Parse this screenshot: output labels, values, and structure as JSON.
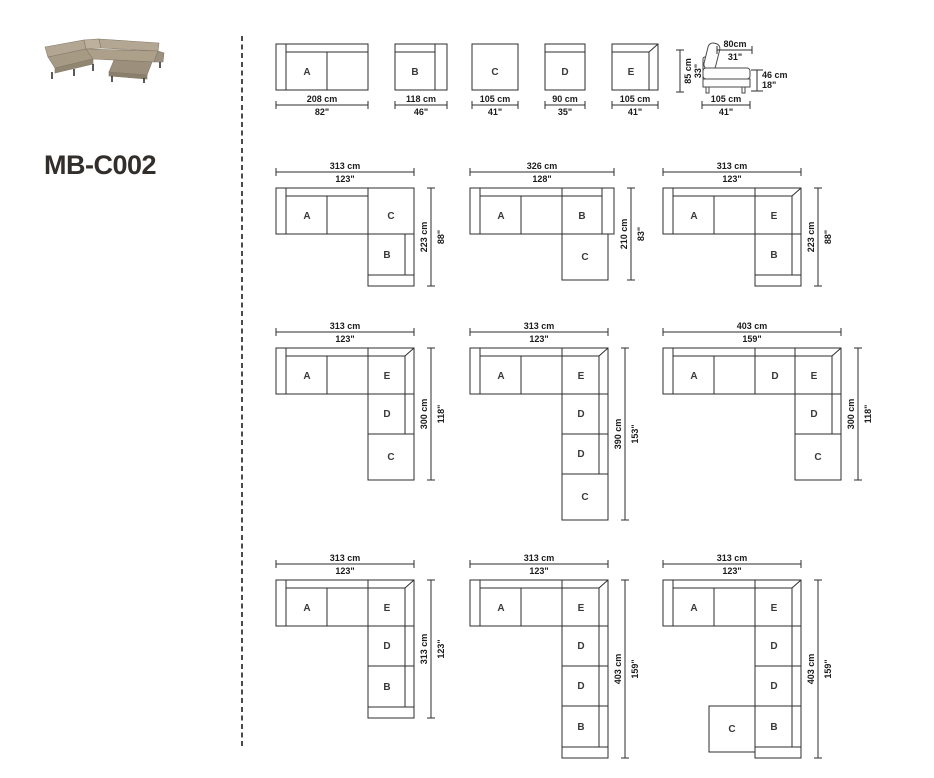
{
  "title": "MB-C002",
  "module_depth_cm": 105,
  "modules": [
    {
      "id": "A",
      "label": "A",
      "width_cm": 208,
      "dim_cm": "208 cm",
      "dim_in": "82\""
    },
    {
      "id": "B",
      "label": "B",
      "width_cm": 118,
      "dim_cm": "118 cm",
      "dim_in": "46\""
    },
    {
      "id": "C",
      "label": "C",
      "width_cm": 105,
      "dim_cm": "105 cm",
      "dim_in": "41\""
    },
    {
      "id": "D",
      "label": "D",
      "width_cm": 90,
      "dim_cm": "90 cm",
      "dim_in": "35\""
    },
    {
      "id": "E",
      "label": "E",
      "width_cm": 105,
      "dim_cm": "105 cm",
      "dim_in": "41\""
    }
  ],
  "side_view": {
    "width_top_cm": "80cm",
    "width_top_in": "31\"",
    "height_cm": "85 cm",
    "height_in": "33\"",
    "seat_height_cm": "46 cm",
    "seat_height_in": "18\"",
    "depth_cm": "105 cm",
    "depth_in": "41\""
  },
  "configurations": [
    {
      "name": "config-1",
      "width_cm": "313 cm",
      "width_in": "123\"",
      "height_cm": "223 cm",
      "height_in": "88\"",
      "top_row": [
        "A",
        "C"
      ],
      "right_column": [
        "B"
      ]
    },
    {
      "name": "config-2",
      "width_cm": "326 cm",
      "width_in": "128\"",
      "height_cm": "210 cm",
      "height_in": "83\"",
      "top_row": [
        "A",
        "B"
      ],
      "right_column": [
        "C"
      ]
    },
    {
      "name": "config-3",
      "width_cm": "313 cm",
      "width_in": "123\"",
      "height_cm": "223 cm",
      "height_in": "88\"",
      "top_row": [
        "A",
        "E"
      ],
      "right_column": [
        "B"
      ]
    },
    {
      "name": "config-4",
      "width_cm": "313 cm",
      "width_in": "123\"",
      "height_cm": "300 cm",
      "height_in": "118\"",
      "top_row": [
        "A",
        "E"
      ],
      "right_column": [
        "D",
        "C"
      ]
    },
    {
      "name": "config-5",
      "width_cm": "313 cm",
      "width_in": "123\"",
      "height_cm": "390 cm",
      "height_in": "153\"",
      "top_row": [
        "A",
        "E"
      ],
      "right_column": [
        "D",
        "D",
        "C"
      ]
    },
    {
      "name": "config-6",
      "width_cm": "403 cm",
      "width_in": "159\"",
      "height_cm": "300 cm",
      "height_in": "118\"",
      "top_row": [
        "A",
        "D",
        "E"
      ],
      "right_column": [
        "D",
        "C"
      ]
    },
    {
      "name": "config-7",
      "width_cm": "313 cm",
      "width_in": "123\"",
      "height_cm": "313 cm",
      "height_in": "123\"",
      "top_row": [
        "A",
        "E"
      ],
      "right_column": [
        "D",
        "B"
      ]
    },
    {
      "name": "config-8",
      "width_cm": "313 cm",
      "width_in": "123\"",
      "height_cm": "403 cm",
      "height_in": "159\"",
      "top_row": [
        "A",
        "E"
      ],
      "right_column": [
        "D",
        "D",
        "B"
      ]
    },
    {
      "name": "config-9",
      "width_cm": "313 cm",
      "width_in": "123\"",
      "height_cm": "403 cm",
      "height_in": "159\"",
      "top_row": [
        "A",
        "E"
      ],
      "right_column": [
        "D",
        "D",
        "B"
      ],
      "side_module": "C"
    }
  ]
}
